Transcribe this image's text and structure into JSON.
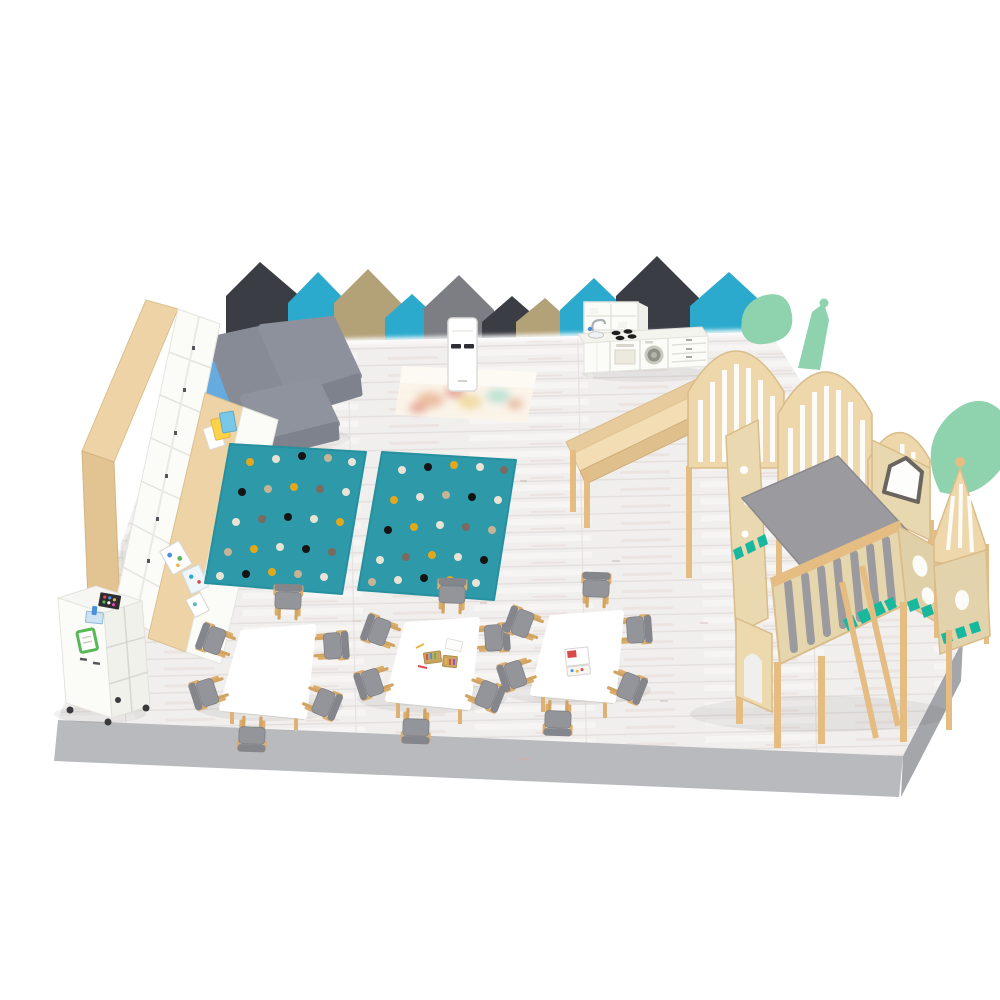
{
  "scene": {
    "type": "3d-room-render",
    "title": "Kindergarten classroom - isometric 3D render",
    "room": "preschool play and activity room",
    "view": "isometric from above-front",
    "background": "#ffffff"
  },
  "palette": {
    "floor": "#f1efee",
    "plinth_front": "#b8babe",
    "plinth_side": "#a4a6aa",
    "panel_charcoal": "#3a3d44",
    "panel_teal": "#2baacd",
    "panel_tan": "#b3a178",
    "panel_gray": "#7c7e83",
    "wood_light": "#edd3a6",
    "wood_frame": "#e5bc82",
    "plywood": "#e8d8b0",
    "white_furniture": "#fbfbf8",
    "sofa_gray": "#8d919b",
    "sofa_blue": "#66abdf",
    "rug_teal": "#2e99a8",
    "mint": "#8fd3ae",
    "teal_accent": "#17b89e",
    "deck_gray": "#9b9b9f",
    "chair_gray": "#94959a",
    "chair_wood": "#dcae6e",
    "table_white": "#ffffff"
  },
  "wall_panels": [
    {
      "shape": "house",
      "size": "large",
      "color": "#3a3d44"
    },
    {
      "shape": "house",
      "size": "medium",
      "color": "#2baacd"
    },
    {
      "shape": "house",
      "size": "medium",
      "color": "#b3a178"
    },
    {
      "shape": "house",
      "size": "small",
      "color": "#2baacd"
    },
    {
      "shape": "house",
      "size": "medium",
      "color": "#7c7e83"
    },
    {
      "shape": "house",
      "size": "small",
      "color": "#3a3d44"
    },
    {
      "shape": "house",
      "size": "small",
      "color": "#b3a178"
    },
    {
      "shape": "house",
      "size": "medium",
      "color": "#2baacd"
    },
    {
      "shape": "house",
      "size": "large",
      "color": "#3a3d44"
    },
    {
      "shape": "house",
      "size": "medium",
      "color": "#2baacd"
    }
  ],
  "furniture": {
    "wardrobe": {
      "label": "tall locker wardrobe, birch frame with white doors",
      "doors": 7
    },
    "low_shelf": {
      "label": "low storage cabinet with white fronts and picture books displayed on top"
    },
    "sofa": {
      "label": "modular corner sofa",
      "pieces": [
        "chaise",
        "corner seat",
        "ottoman"
      ],
      "seat_color": "#8d919b",
      "backrest_color": "#66abdf"
    },
    "rugs": {
      "label": "teal polka-dot rugs",
      "count": 2,
      "color": "#2e99a8",
      "dot_colors": [
        "#e9e3d6",
        "#e2a81c",
        "#141414",
        "#7a6a5f",
        "#c4b494"
      ]
    },
    "projector": {
      "label": "interactive floor projector",
      "body_color": "#ffffff"
    },
    "projection": {
      "label": "projected game image on the floor"
    },
    "play_kitchen": {
      "label": "toy kitchen with hutch, sink, stove, oven, washer and drawers",
      "color": "#fbfbf8",
      "burners": 4
    },
    "play_castle": {
      "label": "wooden play castle with slide, arch walls, balcony, turret and mint trees",
      "accents": [
        "mint leaves",
        "teal crenellation",
        "green flag",
        "pentagon windows"
      ]
    },
    "slide": {
      "label": "wooden slide"
    },
    "tables": {
      "label": "children's activity tables",
      "count": 3,
      "top_color": "#ffffff",
      "chairs_per_table": 6,
      "chair": {
        "frame": "beech wood",
        "seat_color": "#94959a"
      },
      "items_on_tables": [
        "crayon boxes",
        "picture book"
      ]
    },
    "trolley": {
      "label": "white art trolley on casters with art supplies and green board"
    }
  },
  "platform": {
    "label": "whitewashed wood plank floor on gray plinth",
    "floor_color": "#f1efee",
    "plinth_color": "#b8babe"
  }
}
